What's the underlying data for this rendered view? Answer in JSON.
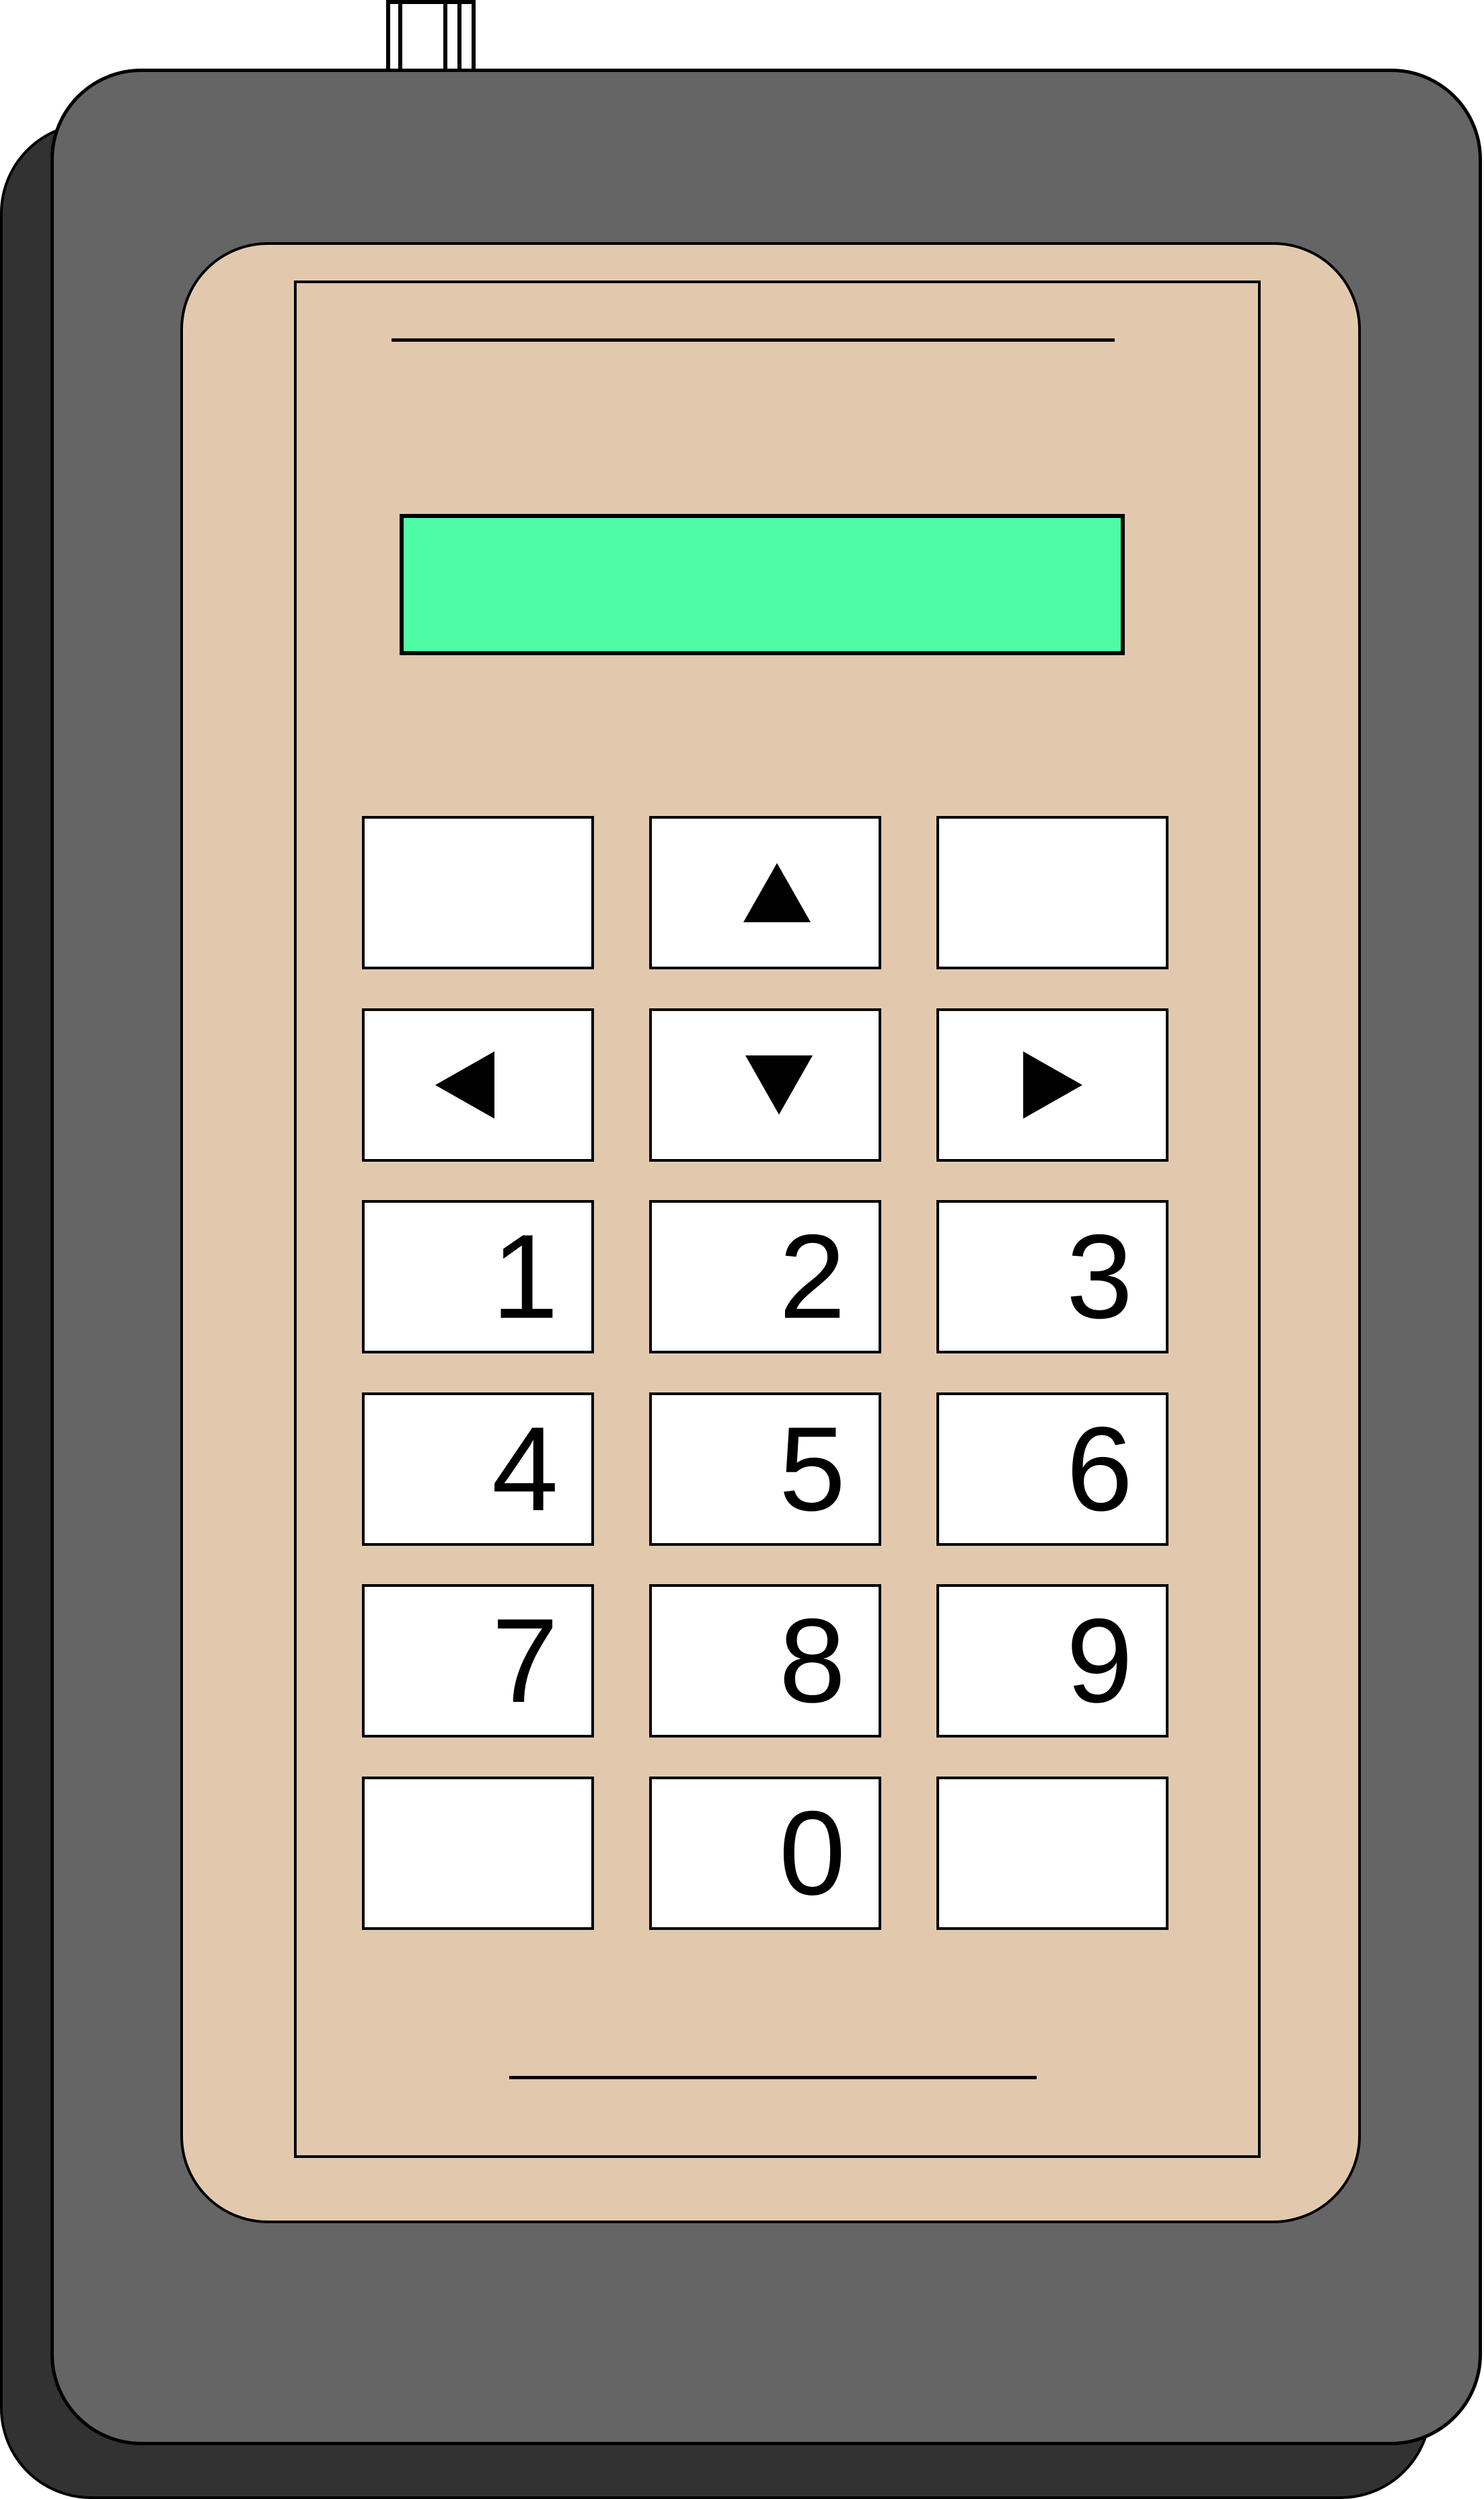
{
  "colors": {
    "body": "#656565",
    "shadow": "#323232",
    "panel": "#E2C9AE",
    "display": "#50FBA5",
    "key": "#FFFFFF",
    "outline": "#000000"
  },
  "display": {
    "text": ""
  },
  "keypad": {
    "digit_labels": [
      "1",
      "2",
      "3",
      "4",
      "5",
      "6",
      "7",
      "8",
      "9",
      "0"
    ],
    "arrows": {
      "up": "▲",
      "down": "▼",
      "left": "◀",
      "right": "▶"
    },
    "blank_key_count": 4
  }
}
